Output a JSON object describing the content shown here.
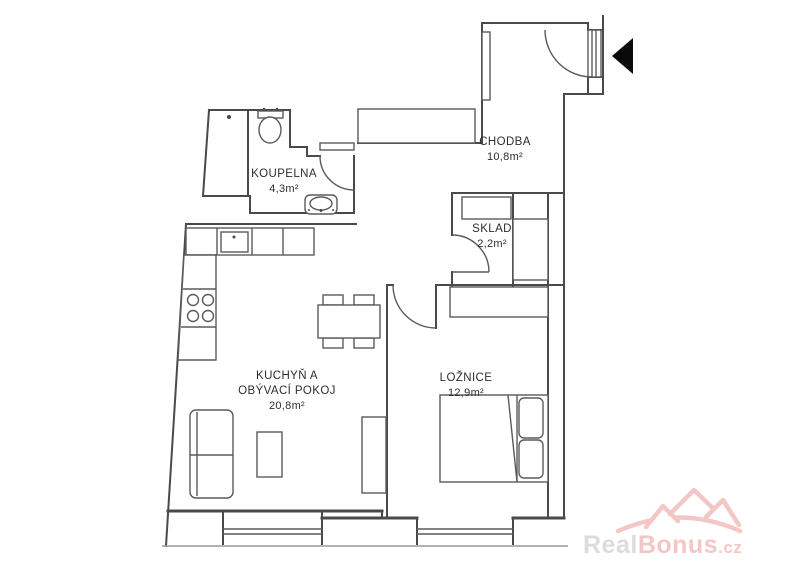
{
  "plan": {
    "rooms": [
      {
        "name": "KOUPELNA",
        "area": "4,3m²"
      },
      {
        "name": "CHODBA",
        "area": "10,8m²"
      },
      {
        "name": "SKLAD",
        "area": "2,2m²"
      },
      {
        "name_line1": "KUCHYŇ A",
        "name_line2": "OBÝVACÍ POKOJ",
        "area": "20,8m²"
      },
      {
        "name": "LOŽNICE",
        "area": "12,9m²"
      }
    ]
  },
  "watermark": {
    "text_real": "Real",
    "text_bonus": "Bonus",
    "text_tld": ".cz",
    "roof_color": "#f2c1c0",
    "real_color": "#d9d9d9"
  },
  "colors": {
    "wall": "#4a4a4a",
    "background": "#ffffff",
    "entry_arrow": "#0a0a0a"
  }
}
